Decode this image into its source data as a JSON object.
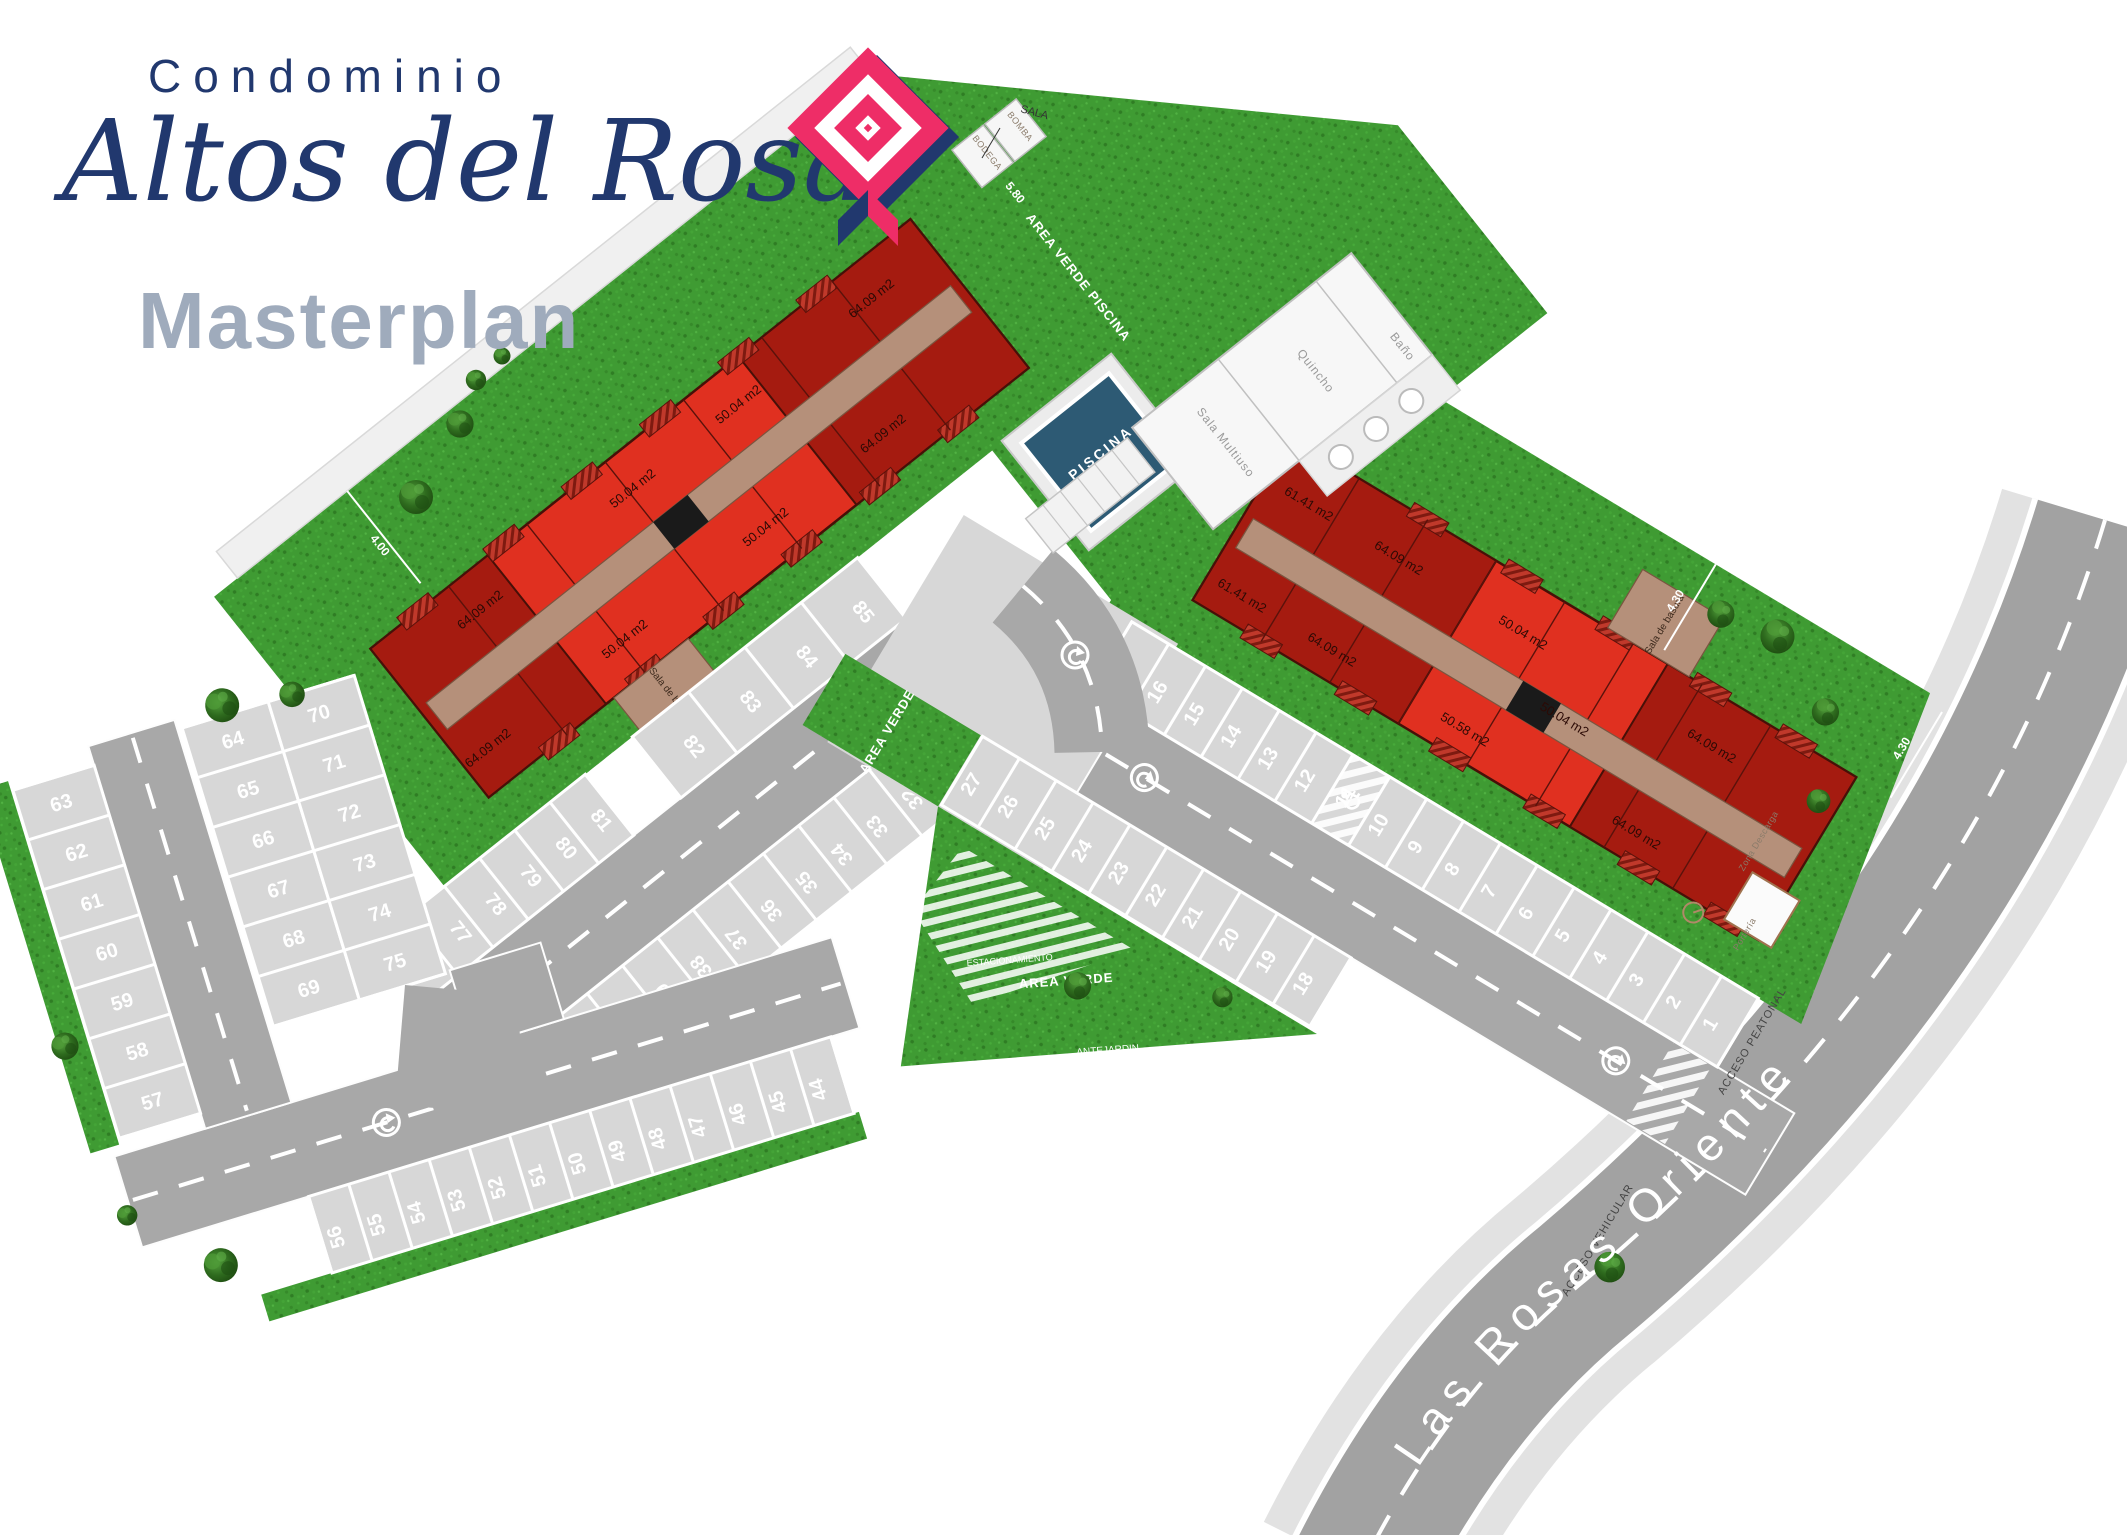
{
  "brand": {
    "condominio": "Condominio",
    "name": "Altos del Rosal",
    "masterplan": "Masterplan"
  },
  "street": {
    "name": "Las Rosas Oriente"
  },
  "pool": {
    "label": "PISCINA"
  },
  "clubhouse": {
    "sala_multiuso": "Sala Multiuso",
    "quincho": "Quincho",
    "bano": "Baño"
  },
  "rooms": {
    "bodega": "BODEGA",
    "bomba": "BOMBA",
    "sala": "SALA",
    "sala_basura": "Sala de basura",
    "porteria": "Portería",
    "zona_descarga": "Zona Descarga"
  },
  "areas": {
    "verde": "AREA VERDE",
    "verde_piscina": "AREA VERDE PISCINA",
    "antejardin": "ANTEJARDIN",
    "estacionamiento": "ESTACIONAMIENTO"
  },
  "access": {
    "peatonal": "ACCESO PEATONAL",
    "vehicular": "ACCESO VEHICULAR"
  },
  "dims": {
    "d580": "5.80",
    "d400": "4.00",
    "d430": "4.30",
    "d85": "8,5"
  },
  "units_left": [
    "64.09 m2",
    "64.09 m2",
    "50.04 m2",
    "50.04 m2",
    "50.04 m2",
    "50.04 m2",
    "64.09 m2",
    "64.09 m2"
  ],
  "units_right": [
    "61.41 m2",
    "64.09 m2",
    "61.41 m2",
    "64.09 m2",
    "50.58 m2",
    "50.04 m2",
    "50.04 m2",
    "64.09 m2",
    "64.09 m2"
  ],
  "parking": {
    "r_upper": [
      1,
      2,
      3,
      4,
      5,
      6,
      7,
      8,
      9,
      10,
      11,
      12,
      13,
      14,
      15,
      16,
      17
    ],
    "r_lower": [
      18,
      19,
      20,
      21,
      22,
      23,
      24,
      25,
      26,
      27
    ],
    "l_lower_a": [
      28,
      29,
      30,
      31,
      32,
      33,
      34,
      35,
      36,
      37,
      38,
      39,
      40,
      41,
      42,
      43
    ],
    "l_lower_b": [
      44,
      45,
      46,
      47,
      48,
      49,
      50,
      51,
      52,
      53,
      54,
      55,
      56
    ],
    "col_57_63": [
      57,
      58,
      59,
      60,
      61,
      62,
      63
    ],
    "bank_64_69": [
      64,
      65,
      66,
      67,
      68,
      69
    ],
    "bank_70_75": [
      70,
      71,
      72,
      73,
      74,
      75
    ],
    "col_76_81": [
      76,
      77,
      78,
      79,
      80,
      81
    ],
    "upper_82_85": [
      82,
      83,
      84,
      85
    ]
  },
  "colors": {
    "navy": "#21386e",
    "pink": "#ee2d67",
    "title_gray": "#9fabbc",
    "grass": "#3f9b33",
    "road": "#a8a8a8",
    "apron": "#d7d7d7",
    "building_bright": "#e03020",
    "building_dark": "#a51b10",
    "corridor": "#b5907a",
    "pool_water": "#2d5a74"
  }
}
